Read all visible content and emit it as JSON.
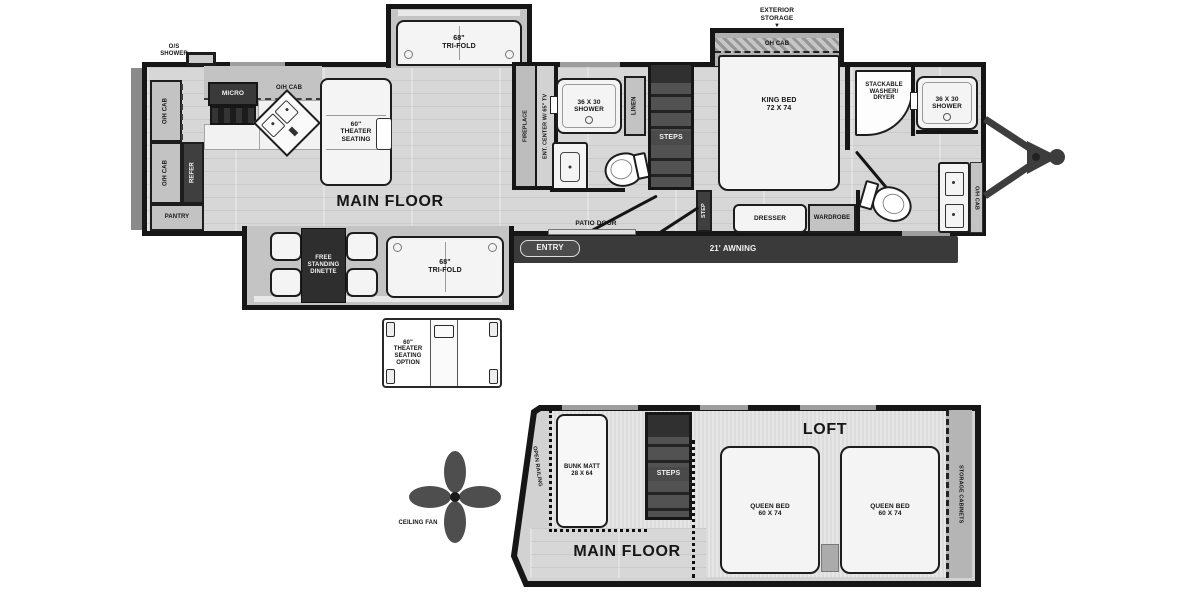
{
  "main": {
    "floor_label": "MAIN FLOOR",
    "os_shower": "O/S\nSHOWER",
    "oh_cab": "O/H CAB",
    "refer": "REFER",
    "pantry": "PANTRY",
    "micro": "MICRO",
    "theater_seating": "60\"\nTHEATER\nSEATING",
    "tri_fold": "68\"\nTRI-FOLD",
    "fireplace": "FIREPLACE",
    "ent_center": "ENT. CENTER W/ 65\" TV",
    "shower_36x30": "36 X 30\nSHOWER",
    "linen": "LINEN",
    "steps": "STEPS",
    "step": "STEP",
    "patio_door": "PATIO DOOR",
    "entry": "ENTRY",
    "awning": "21' AWNING",
    "exterior_storage": "EXTERIOR\nSTORAGE",
    "exterior_storage_arrow": "▼",
    "oh_cab_bed": "OH CAB",
    "king_bed": "KING BED\n72 X 74",
    "washer_dryer": "STACKABLE\nWASHER/\nDRYER",
    "dresser": "DRESSER",
    "wardrobe": "WARDROBE",
    "dinette": "FREE\nSTANDING\nDINETTE",
    "theater_option": "60\"\nTHEATER\nSEATING\nOPTION",
    "ceiling_fan": "CEILING FAN"
  },
  "loft": {
    "title": "LOFT",
    "open_railing": "OPEN RAILING",
    "bunk_matt": "BUNK MATT\n28 X 64",
    "steps": "STEPS",
    "queen_bed": "QUEEN BED\n60 X 74",
    "storage_cabinets": "STORAGE CABINETS",
    "main_floor": "MAIN FLOOR"
  },
  "colors": {
    "wall": "#161616",
    "floor": "#d7d7d7",
    "dark_fixture": "#3f3f3f",
    "awning": "#3a3a3a"
  }
}
